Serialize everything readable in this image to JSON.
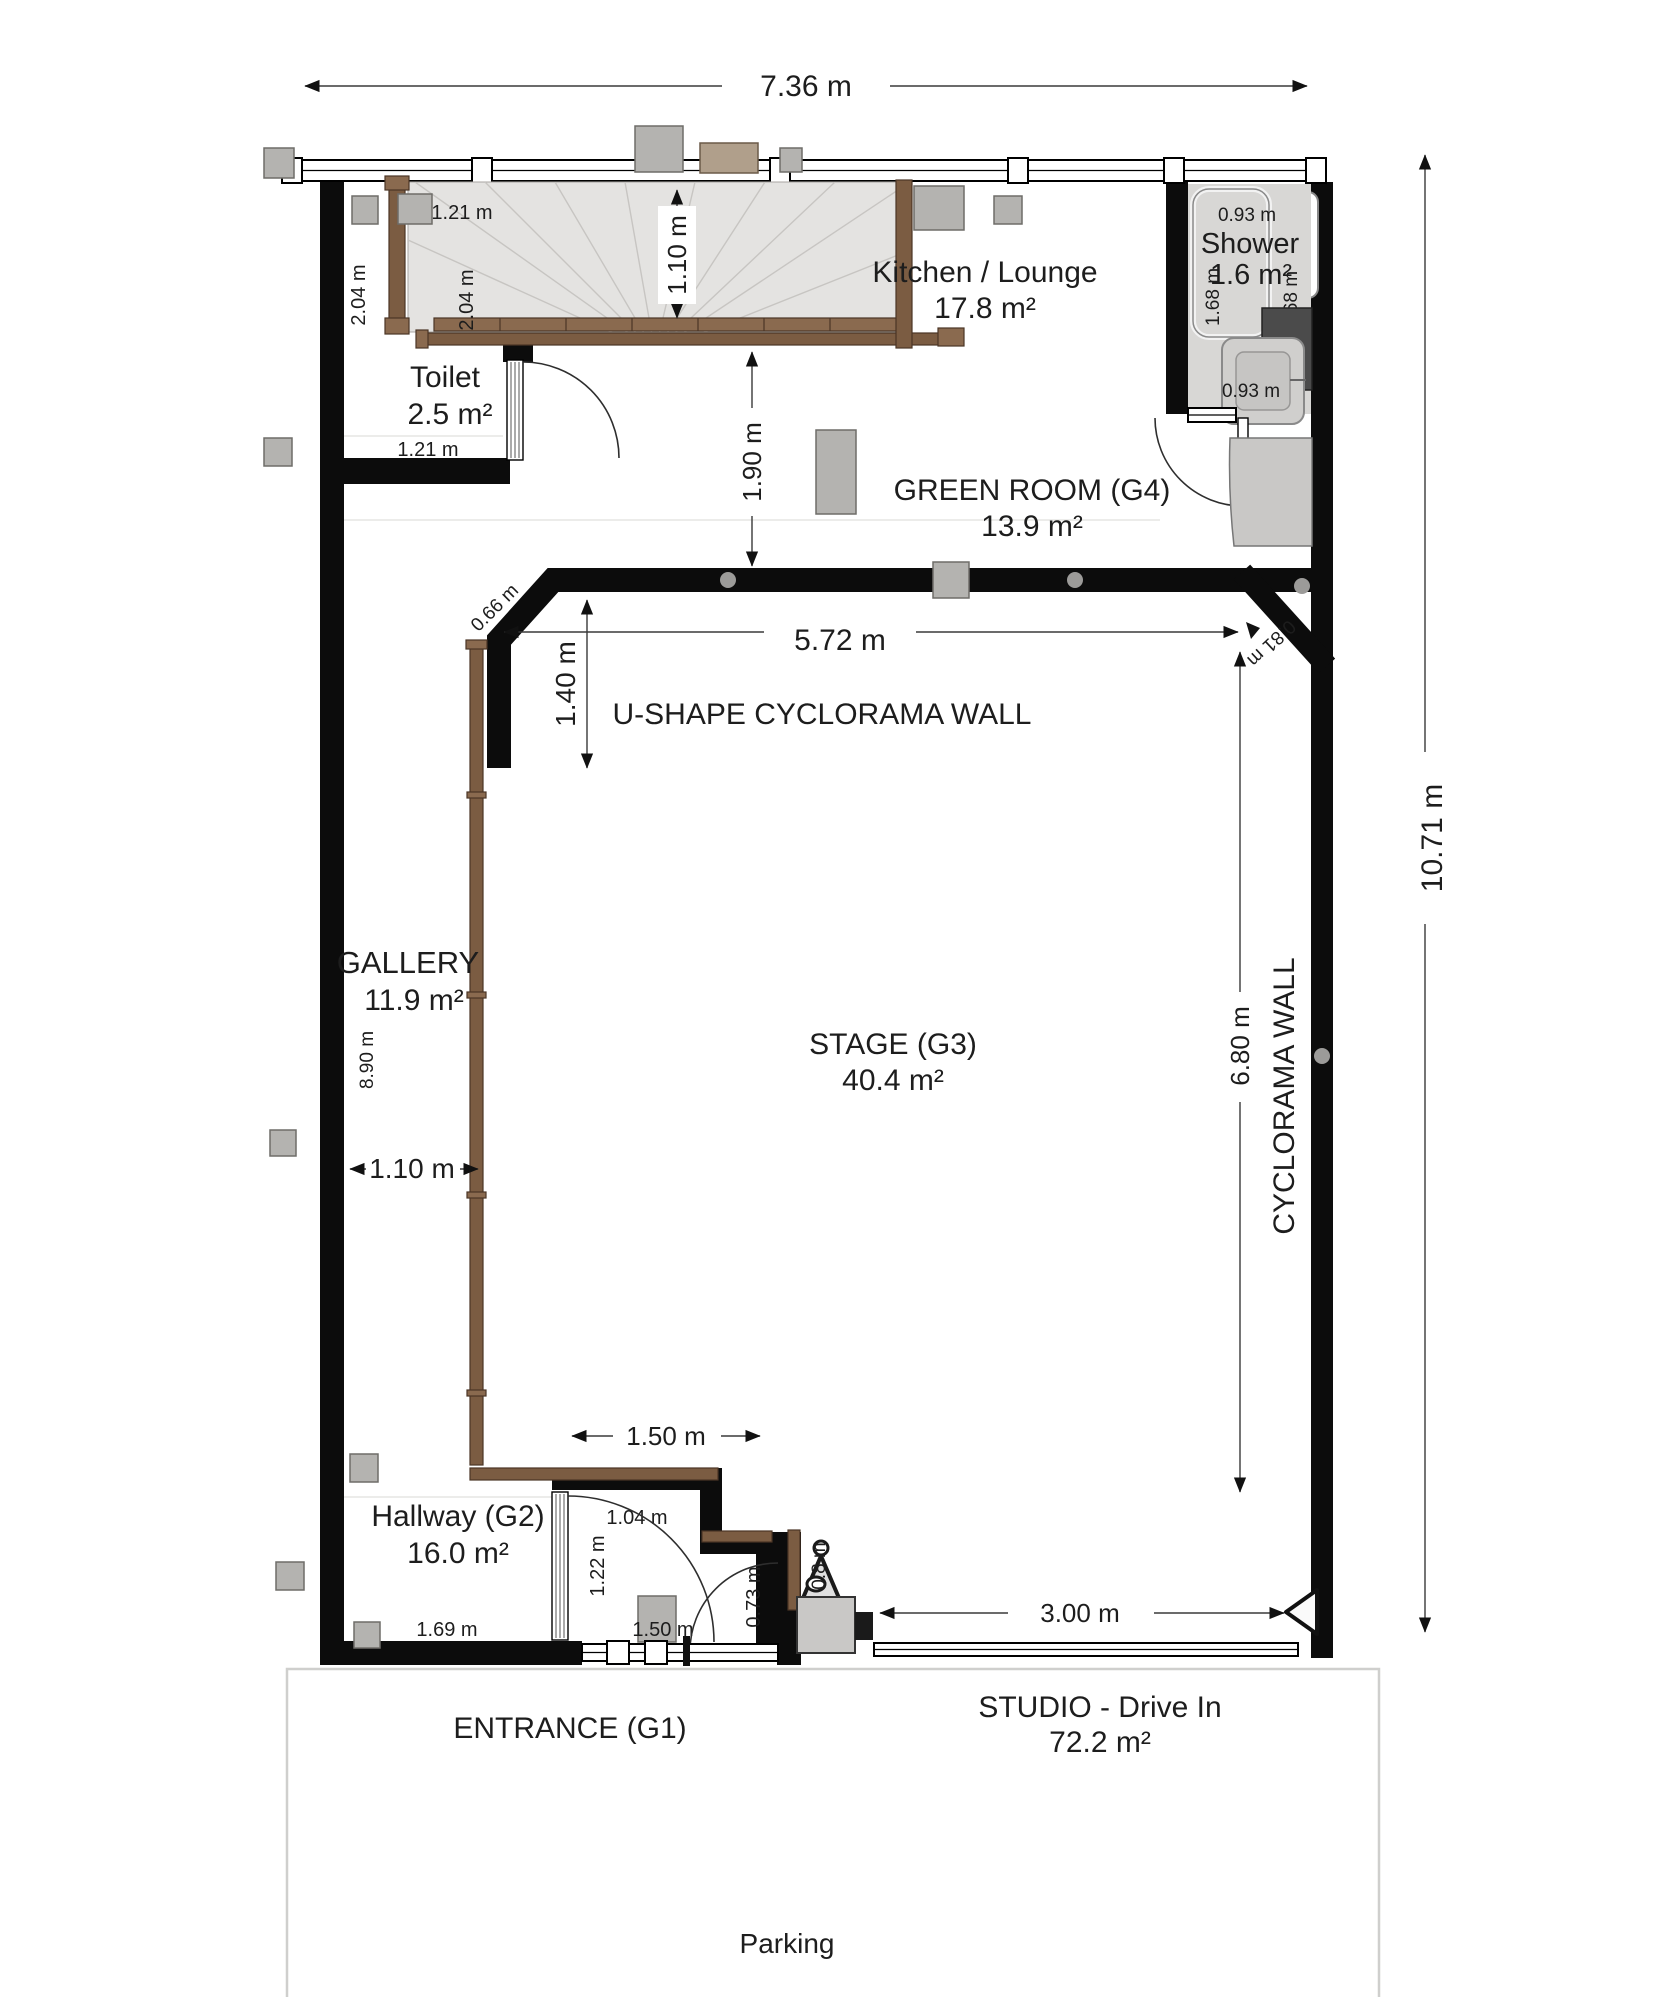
{
  "plan": {
    "units": "m",
    "rooms": {
      "kitchen_lounge": {
        "name": "Kitchen / Lounge",
        "area": "17.8 m²"
      },
      "shower": {
        "name": "Shower",
        "area": "1.6 m²"
      },
      "toilet": {
        "name": "Toilet",
        "area": "2.5 m²"
      },
      "green_room": {
        "name": "GREEN ROOM (G4)",
        "area": "13.9 m²"
      },
      "gallery": {
        "name": "GALLERY",
        "area": "11.9 m²"
      },
      "stage": {
        "name": "STAGE (G3)",
        "area": "40.4 m²"
      },
      "hallway": {
        "name": "Hallway (G2)",
        "area": "16.0 m²"
      },
      "studio_drive_in": {
        "name": "STUDIO - Drive In",
        "area": "72.2 m²"
      },
      "entrance": {
        "name": "ENTRANCE (G1)"
      },
      "parking": {
        "name": "Parking"
      }
    },
    "wall_labels": {
      "u_shape_cyclorama": "U-SHAPE CYCLORAMA WALL",
      "cyclorama": "CYCLORAMA WALL"
    },
    "dimensions": {
      "building_width": "7.36 m",
      "building_height": "10.71 m",
      "stair_landing_width": "1.10 m",
      "toilet_wall_left": "2.04 m",
      "toilet_wall_right": "2.04 m",
      "toilet_width_top": "1.21 m",
      "toilet_width_bottom": "1.21 m",
      "green_room_depth": "1.90 m",
      "shower_width_top": "0.93 m",
      "shower_depth_left": "1.68 m",
      "shower_depth_right": "1.68 m",
      "shower_width_bottom": "0.93 m",
      "cyclorama_opening_width": "5.72 m",
      "cyclorama_corner_left": "0.66 m",
      "cyclorama_corner_right": "0.81 m",
      "cyclorama_offset": "1.40 m",
      "stage_depth": "6.80 m",
      "gallery_length": "8.90 m",
      "gallery_width": "1.10 m",
      "hallway_opening_width": "1.50 m",
      "hallway_niche_width": "1.04 m",
      "hallway_niche_depth": "1.22 m",
      "hallway_door_width": "1.69 m",
      "entrance_door_width": "1.50 m",
      "entrance_side_depth": "0.73 m",
      "equipment_size": "0.8 m",
      "drive_in_opening_width": "3.00 m"
    },
    "colors": {
      "wall": "#0c0c0c",
      "wood": "#7b5c42",
      "wood_dark": "#4a3526",
      "furniture_gray": "#b4b3b0",
      "stair_floor": "#e4e3e1",
      "shower_floor": "#d8d7d5",
      "dark_unit": "#4b4b4b",
      "dimension_line": "#3a3a3a",
      "parking_line": "#cfcfcd"
    }
  }
}
